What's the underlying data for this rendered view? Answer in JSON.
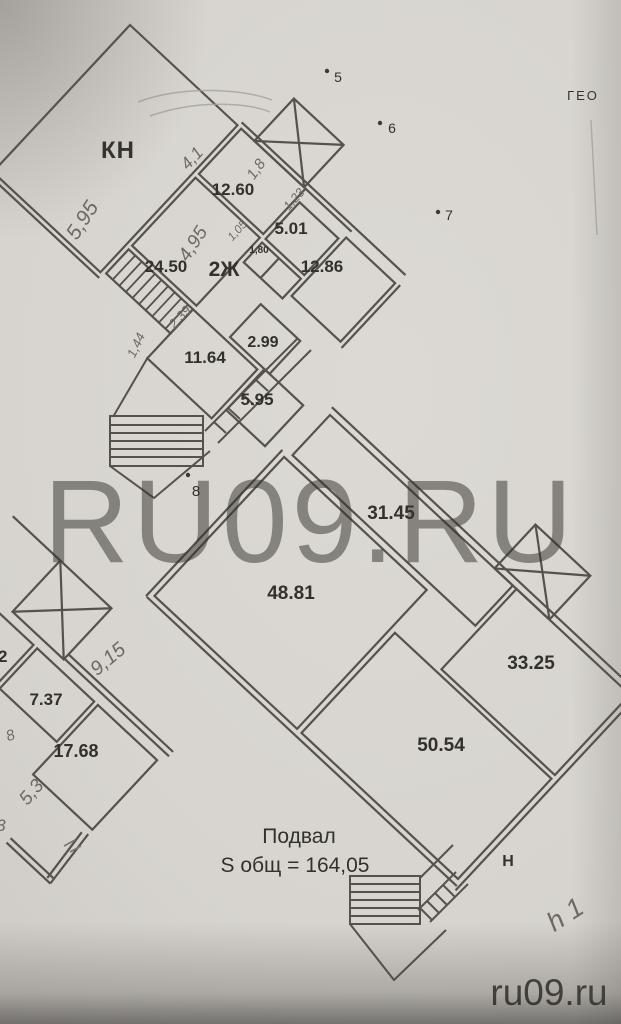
{
  "watermarks": {
    "center": "RU09.RU",
    "corner": "ru09.ru",
    "top_right": "ГЕО"
  },
  "plan": {
    "basement_title": "Подвал",
    "basement_area": "S общ = 164,05",
    "upper": {
      "rooms": {
        "kn": "КН",
        "r1260": "12.60",
        "r501": "5.01",
        "r2450": "24.50",
        "apt": "2Ж",
        "cell180": "1,80",
        "r1286": "12.86",
        "r299": "2.99",
        "r1164": "11.64",
        "r595": "5.95"
      },
      "dims": {
        "d41": "4,1",
        "d18": "1,8",
        "d595": "5,95",
        "d495": "4,95",
        "d123": "1,23",
        "d105": "1,05",
        "d239": "2,39",
        "d144": "1,44"
      }
    },
    "lower": {
      "rooms": {
        "r3145": "31.45",
        "r4881": "48.81",
        "r3325": "33.25",
        "r5054": "50.54",
        "r737": "7.37",
        "r1768": "17.68",
        "r62": "62",
        "entry": "Н"
      },
      "dims": {
        "d915": "9,15",
        "d53": "5,3",
        "d8": "8",
        "d3": "3",
        "h1": "h 1"
      }
    },
    "survey_points": {
      "p5": "5",
      "p6": "6",
      "p7": "7",
      "p8": "8"
    }
  }
}
